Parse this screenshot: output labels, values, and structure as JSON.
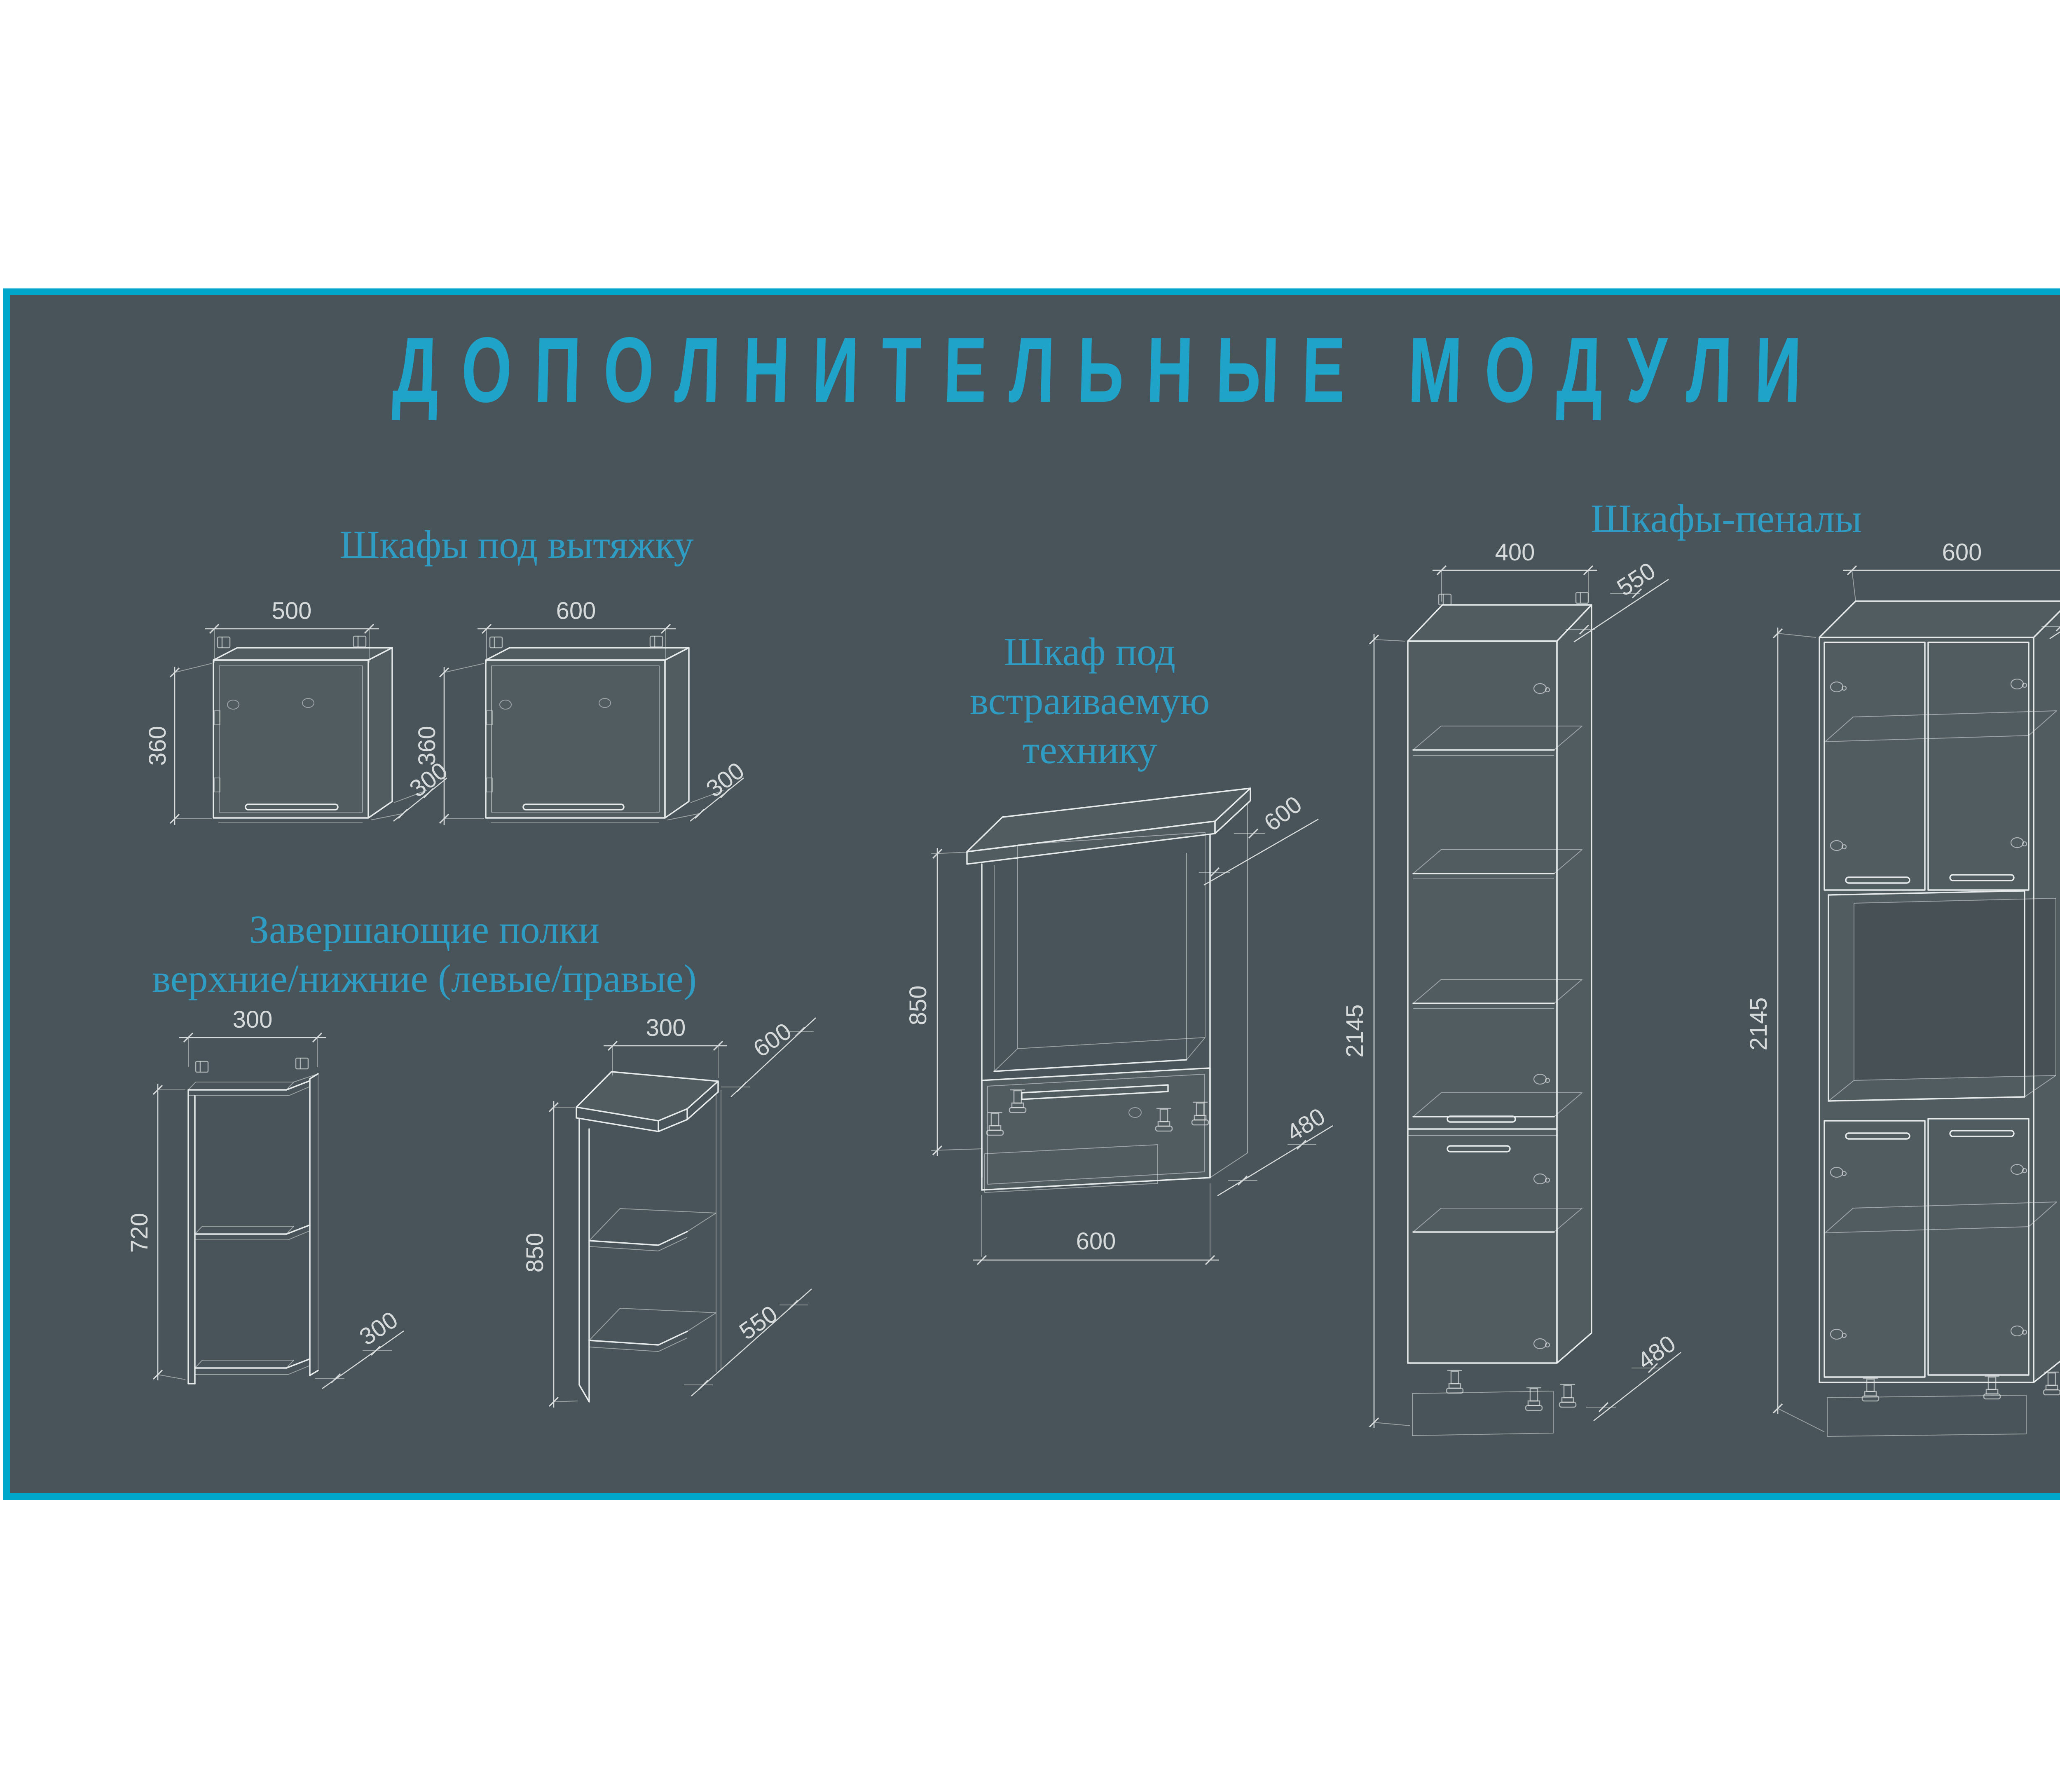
{
  "title": "ДОПОЛНИТЕЛЬНЫЕ МОДУЛИ",
  "colors": {
    "page_bg": "#FFFFFF",
    "panel_bg": "#485459",
    "border": "#00A7CB",
    "title_text": "#1FA3C8",
    "heading_text": "#2F9CC3",
    "drawing_line": "#E6EAEA",
    "dimension_text": "#D6DADA",
    "leg_accent_teal": "#27BFA5"
  },
  "sections": {
    "hood": {
      "heading": "Шкафы под вытяжку",
      "cabinet_500": {
        "width_mm": "500",
        "height_mm": "360",
        "depth_mm": "300"
      },
      "cabinet_600": {
        "width_mm": "600",
        "height_mm": "360",
        "depth_mm": "300"
      }
    },
    "end_shelves": {
      "heading_line1": "Завершающие полки",
      "heading_line2": "верхние/нижние (левые/правые)",
      "shelf_upper": {
        "width_mm": "300",
        "height_mm": "720",
        "depth_mm": "300"
      },
      "shelf_lower": {
        "width_mm": "300",
        "height_mm": "850",
        "depth_top_mm": "600",
        "depth_bottom_mm": "550"
      }
    },
    "built_in": {
      "heading_line1": "Шкаф под",
      "heading_line2": "встраиваемую",
      "heading_line3": "технику",
      "oven_cabinet": {
        "width_mm": "600",
        "height_mm": "850",
        "depth_top_mm": "600",
        "depth_bottom_mm": "480"
      }
    },
    "tall": {
      "heading": "Шкафы-пеналы",
      "cabinet_400": {
        "width_mm": "400",
        "height_mm": "2145",
        "depth_top_mm": "550",
        "depth_bottom_mm": "480"
      },
      "cabinet_600": {
        "width_mm": "600",
        "height_mm": "2145",
        "depth_top_mm": "550",
        "depth_bottom_mm": "480"
      }
    }
  }
}
